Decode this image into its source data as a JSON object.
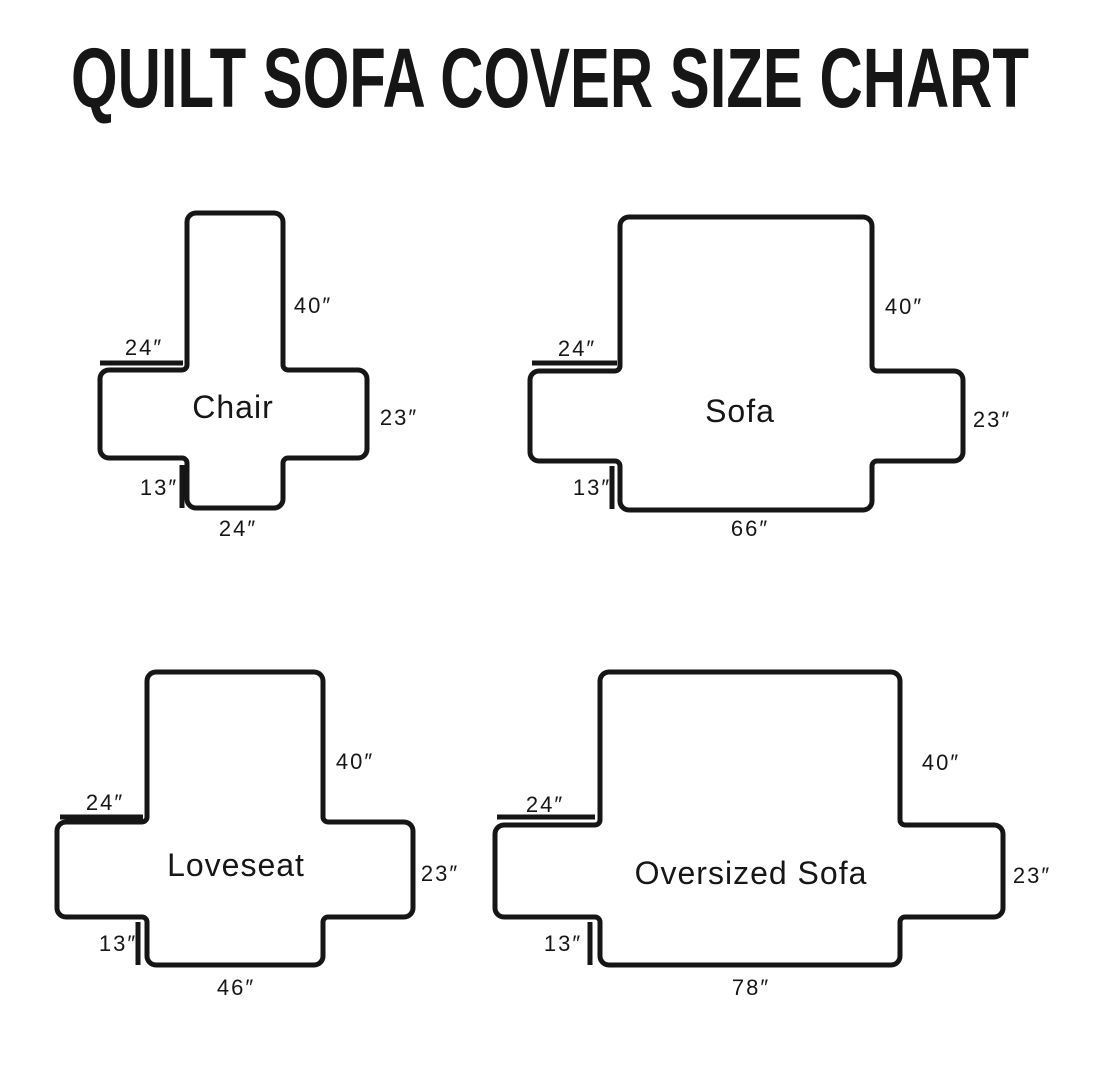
{
  "title": "QUILT SOFA COVER SIZE CHART",
  "colors": {
    "ink": "#161616",
    "background": "#ffffff"
  },
  "diagrams": [
    {
      "name": "Chair",
      "back_height": "40″",
      "arm_top_width": "24″",
      "side_height": "23″",
      "front_skirt_height": "13″",
      "seat_front_width": "24″"
    },
    {
      "name": "Sofa",
      "back_height": "40″",
      "arm_top_width": "24″",
      "side_height": "23″",
      "front_skirt_height": "13″",
      "seat_front_width": "66″"
    },
    {
      "name": "Loveseat",
      "back_height": "40″",
      "arm_top_width": "24″",
      "side_height": "23″",
      "front_skirt_height": "13″",
      "seat_front_width": "46″"
    },
    {
      "name": "Oversized Sofa",
      "back_height": "40″",
      "arm_top_width": "24″",
      "side_height": "23″",
      "front_skirt_height": "13″",
      "seat_front_width": "78″"
    }
  ]
}
